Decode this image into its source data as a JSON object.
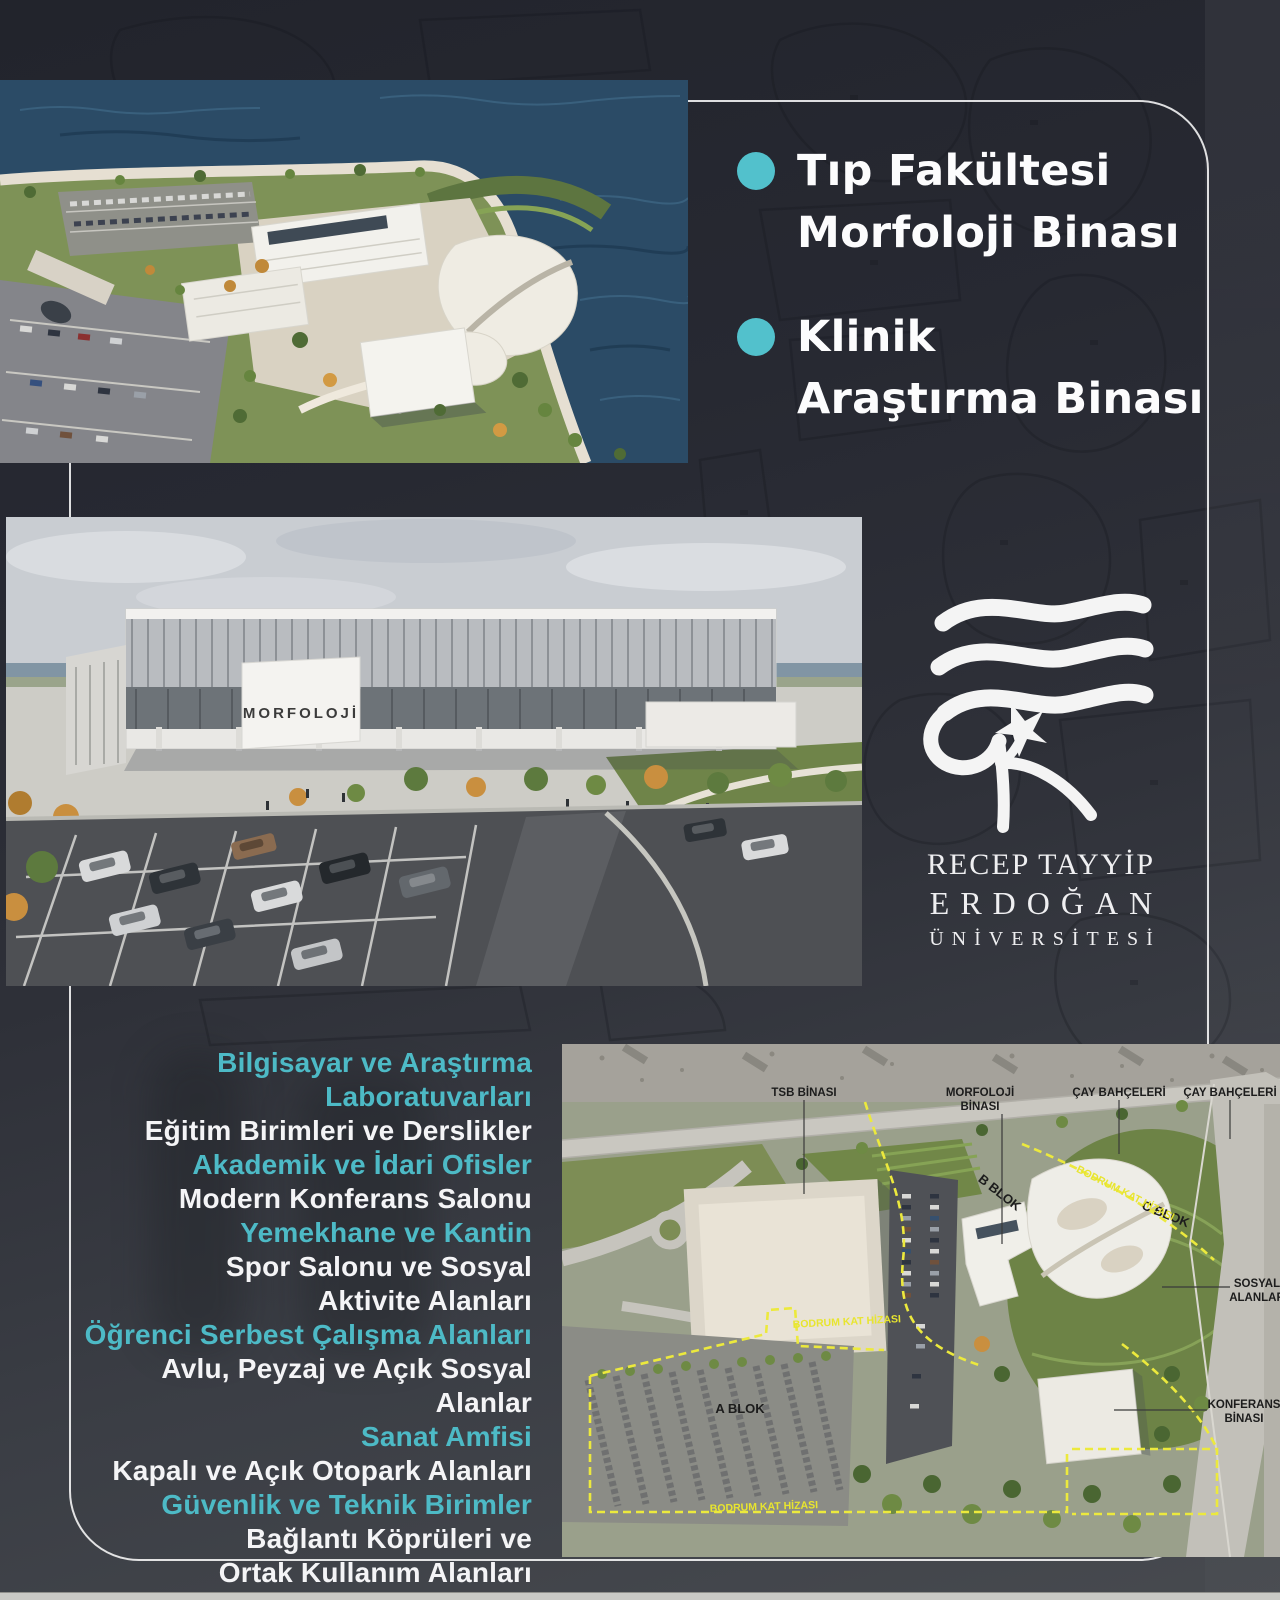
{
  "colors": {
    "accent_teal": "#52c1cc",
    "list_teal": "#4dbac6",
    "text_white": "#f4f4f6",
    "background_top": "#22242c",
    "background_bottom": "#474a4f",
    "plan_boundary_yellow": "#ece93d"
  },
  "headline": {
    "items": [
      {
        "lines": [
          "Tıp Fakültesi",
          "Morfoloji Binası"
        ]
      },
      {
        "lines": [
          "Klinik",
          "Araştırma Binası"
        ]
      }
    ]
  },
  "logo": {
    "line1": "RECEP TAYYİP",
    "line2": "ERDOĞAN",
    "line3": "ÜNİVERSİTESİ"
  },
  "middle_photo": {
    "building_sign": "MORFOLOJİ"
  },
  "features": {
    "lines": [
      {
        "text": "Bilgisayar ve Araştırma",
        "color": "teal"
      },
      {
        "text": "Laboratuvarları",
        "color": "teal"
      },
      {
        "text": "Eğitim Birimleri ve Derslikler",
        "color": "white"
      },
      {
        "text": "Akademik ve İdari Ofisler",
        "color": "teal"
      },
      {
        "text": "Modern Konferans Salonu",
        "color": "white"
      },
      {
        "text": "Yemekhane ve Kantin",
        "color": "teal"
      },
      {
        "text": "Spor Salonu ve Sosyal",
        "color": "white"
      },
      {
        "text": "Aktivite Alanları",
        "color": "white"
      },
      {
        "text": "Öğrenci Serbest Çalışma Alanları",
        "color": "teal"
      },
      {
        "text": "Avlu, Peyzaj ve Açık Sosyal Alanlar",
        "color": "white"
      },
      {
        "text": "Sanat Amfisi",
        "color": "teal"
      },
      {
        "text": "Kapalı ve Açık Otopark Alanları",
        "color": "white"
      },
      {
        "text": "Güvenlik ve Teknik Birimler",
        "color": "teal"
      },
      {
        "text": "Bağlantı Köprüleri ve",
        "color": "white"
      },
      {
        "text": "Ortak Kullanım Alanları",
        "color": "white"
      }
    ]
  },
  "site_plan": {
    "label_tsb": "TSB BİNASI",
    "label_morfoloji_1": "MORFOLOJİ",
    "label_morfoloji_2": "BİNASI",
    "label_cay_1": "ÇAY BAHÇELERİ",
    "label_cay_2": "ÇAY BAHÇELERİ",
    "label_b_blok": "B BLOK",
    "label_c_blok": "C BLOK",
    "label_a_blok": "A BLOK",
    "label_bodrum_1": "BODRUM KAT HİZASI",
    "label_bodrum_2": "BODRUM KAT HİZASI",
    "label_bodrum_3": "BODRUM KAT HİZASI",
    "label_sosyal_1": "SOSYAL",
    "label_sosyal_2": "ALANLAR",
    "label_konferans_1": "KONFERANS",
    "label_konferans_2": "BİNASI"
  }
}
